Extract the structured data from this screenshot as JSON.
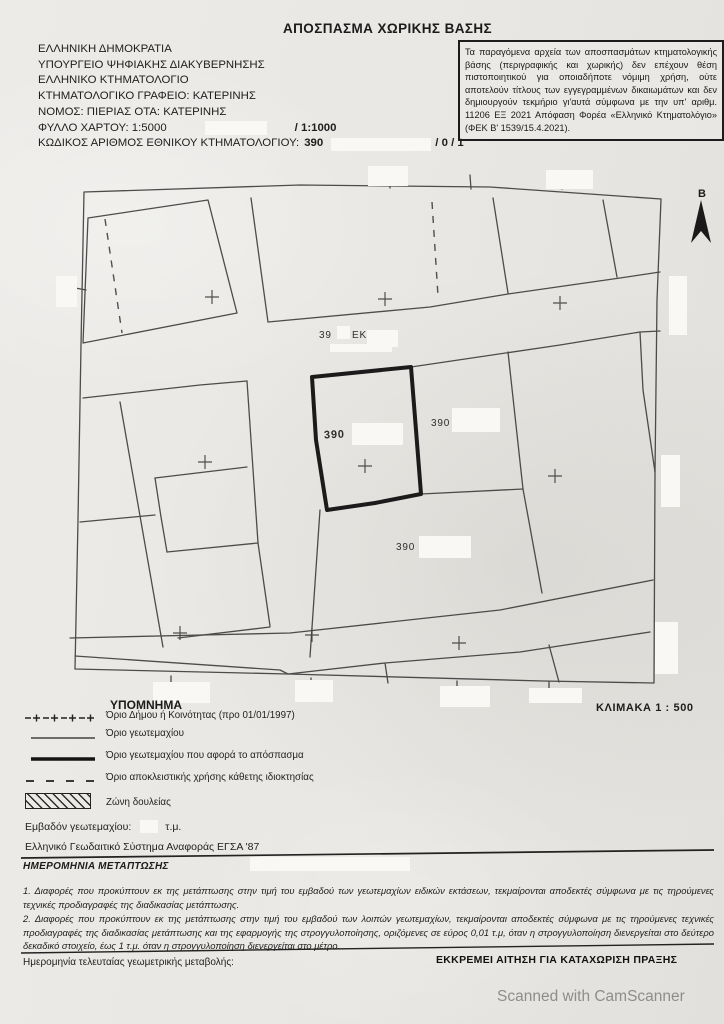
{
  "title": "ΑΠΟΣΠΑΣΜΑ ΧΩΡΙΚΗΣ ΒΑΣΗΣ",
  "header": {
    "line1": "ΕΛΛΗΝΙΚΗ ΔΗΜΟΚΡΑΤΙΑ",
    "line2": "ΥΠΟΥΡΓΕΙΟ ΨΗΦΙΑΚΗΣ ΔΙΑΚΥΒΕΡΝΗΣΗΣ",
    "line3": "ΕΛΛΗΝΙΚΟ ΚΤΗΜΑΤΟΛΟΓΙΟ",
    "line4": "ΚΤΗΜΑΤΟΛΟΓΙΚΟ ΓΡΑΦΕΙΟ: ΚΑΤΕΡΙΝΗΣ",
    "line5": "ΝΟΜΟΣ: ΠΙΕΡΙΑΣ ΟΤΑ: ΚΑΤΕΡΙΝΗΣ",
    "map_sheet_label": "ΦΥΛΛΟ ΧΑΡΤΟΥ: 1:5000",
    "map_sheet_suffix": "/ 1:1000",
    "kaek_label": "ΚΩΔΙΚΟΣ ΑΡΙΘΜΟΣ ΕΘΝΙΚΟΥ ΚΤΗΜΑΤΟΛΟΓΙΟΥ:",
    "kaek_value": "390",
    "kaek_suffix": "/ 0 / 1"
  },
  "disclaimer": "Τα παραγόμενα αρχεία των αποσπασμάτων κτηματολογικής βάσης (περιγραφικής και χωρικής) δεν επέχουν θέση πιστοποιητικού για οποιαδήποτε νόμιμη χρήση, ούτε αποτελούν τίτλους των εγγεγραμμένων δικαιωμάτων και δεν δημιουργούν τεκμήριο γι'αυτά σύμφωνα με την υπ' αριθμ. 11206 ΕΞ 2021 Απόφαση Φορέα «Ελληνικό Κτηματολόγιο» (ΦΕΚ Β' 1539/15.4.2021).",
  "map": {
    "north_label": "Β",
    "scale_label": "ΚΛΙΜΑΚΑ 1 : 500",
    "labels": [
      {
        "text": "39"
      },
      {
        "text": "ΕΚ"
      },
      {
        "text": "390"
      },
      {
        "text": "390"
      },
      {
        "text": "390"
      }
    ]
  },
  "legend": {
    "title": "ΥΠΟΜΝΗΜΑ",
    "items": [
      {
        "symbol": "municipality-boundary",
        "label": "Όριο Δήμου ή Κοινότητας (προ 01/01/1997)"
      },
      {
        "symbol": "parcel-boundary",
        "label": "Όριο γεωτεμαχίου"
      },
      {
        "symbol": "subject-parcel-boundary",
        "label": "Όριο γεωτεμαχίου που αφορά το απόσπασμα"
      },
      {
        "symbol": "exclusive-use-boundary",
        "label": "Όριο αποκλειστικής χρήσης κάθετης ιδιοκτησίας"
      },
      {
        "symbol": "easement-zone",
        "label": "Ζώνη δουλείας"
      }
    ],
    "area_label": "Εμβαδόν γεωτεμαχίου:",
    "area_unit": "τ.μ.",
    "datum": "Ελληνικό Γεωδαιτικό Σύστημα Αναφοράς ΕΓΣΑ '87"
  },
  "migration": {
    "heading": "ΗΜΕΡΟΜΗΝΙΑ ΜΕΤΑΠΤΩΣΗΣ",
    "note1": "1. Διαφορές που προκύπτουν εκ της μετάπτωσης στην τιμή του εμβαδού των γεωτεμαχίων ειδικών εκτάσεων, τεκμαίρονται αποδεκτές σύμφωνα με τις τηρούμενες τεχνικές προδιαγραφές της διαδικασίας μετάπτωσης.",
    "note2": "2. Διαφορές που προκύπτουν εκ της μετάπτωσης στην τιμή του εμβαδού των λοιπών γεωτεμαχίων, τεκμαίρονται αποδεκτές σύμφωνα με τις τηρούμενες τεχνικές προδιαγραφές της διαδικασίας μετάπτωσης και της εφαρμογής της στρογγυλοποίησης, οριζόμενες σε εύρος 0,01 τ.μ, όταν η στρογγυλοποίηση διενεργείται στο δεύτερο δεκαδικό στοιχείο, έως 1 τ.μ. όταν η στρογγυλοποίηση διενεργείται στο μέτρο."
  },
  "footer": {
    "last_change_label": "Ημερομηνία τελευταίας γεωμετρικής μεταβολής:",
    "pending_note": "ΕΚΚΡΕΜΕΙ ΑΙΤΗΣΗ ΓΙΑ ΚΑΤΑΧΩΡΙΣΗ ΠΡΑΞΗΣ"
  },
  "watermark": "Scanned with CamScanner",
  "colors": {
    "paper": "#e9e7e3",
    "ink": "#222222",
    "map_line": "#3f3f3f",
    "subject_parcel_line": "#1b1b1b",
    "redaction": "#f9f8f4",
    "watermark_gray": "#8d8d8d"
  }
}
